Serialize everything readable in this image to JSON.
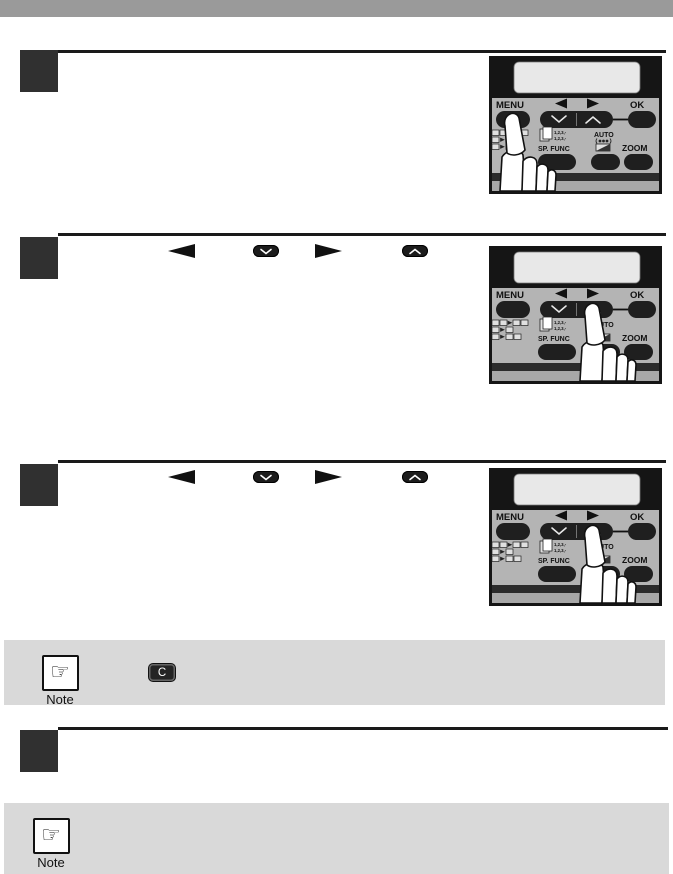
{
  "page": {
    "type": "copier-user-manual-page",
    "background": "#ffffff"
  },
  "top_bar": {
    "color": "#9a9a9a"
  },
  "colors": {
    "step_box": "#303030",
    "heading_rule": "#1a1a1a",
    "note_background": "#d9d9d9",
    "panel_body": "#b4b4b4",
    "panel_top": "#151515",
    "lcd_display": "#e8e8e8",
    "button_dark": "#1f1f1f",
    "key_text": "#ffffff"
  },
  "panel": {
    "menu_label": "MENU",
    "ok_label": "OK",
    "sp_func_label": "SP. FUNC",
    "auto_label": "AUTO",
    "zoom_label": "ZOOM",
    "sort_line1": "1,2,3,-",
    "sort_line2": "1,2,3,-"
  },
  "steps": [
    {
      "index": 1,
      "illustration": "finger pressing MENU button",
      "inline_keys": []
    },
    {
      "index": 2,
      "illustration": "finger pressing up-chevron side of arrow key",
      "inline_keys": [
        "left-arrow",
        "down-chevron-key",
        "right-arrow",
        "up-chevron-key"
      ]
    },
    {
      "index": 3,
      "illustration": "finger pressing up-chevron side of arrow key",
      "inline_keys": [
        "left-arrow",
        "down-chevron-key",
        "right-arrow",
        "up-chevron-key"
      ]
    },
    {
      "index": 4,
      "illustration": null,
      "inline_keys": []
    }
  ],
  "notes": [
    {
      "label": "Note",
      "keys": [
        "C"
      ]
    },
    {
      "label": "Note",
      "keys": []
    }
  ],
  "note": {
    "label": "Note",
    "hand_glyph": "☞"
  },
  "clear_key": {
    "label": "C"
  },
  "icons": {
    "left_arrow_glyph": "◄",
    "right_arrow_glyph": "►",
    "down_chevron_glyph": "∨",
    "up_chevron_glyph": "∧"
  }
}
